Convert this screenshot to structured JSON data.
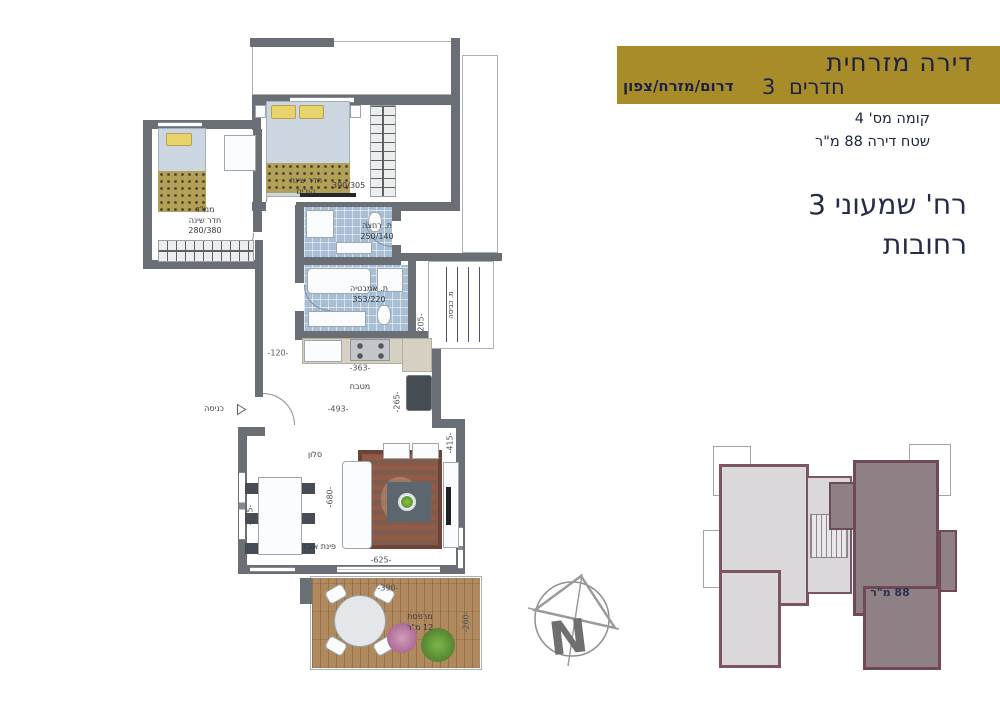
{
  "header": {
    "line1": "דירה  מזרחית",
    "rooms_count": "3",
    "rooms_word": "חדרים",
    "orientation": "דרום/מזרח/צפון",
    "floor": "קומה מס'  4",
    "area": "שטח דירה  88  מ\"ר"
  },
  "address": {
    "line1": "רח' שמעוני 3",
    "line2": "רחובות"
  },
  "plan": {
    "rooms": {
      "mamad": {
        "line1": "ממ\"ד",
        "line2": "חדר שינה",
        "dims": "280/380"
      },
      "parents": {
        "line1": "חדר שינה",
        "line2": "הורים",
        "dims": "390/305"
      },
      "shower": {
        "name": "ת. רחצה",
        "dims": "250/140"
      },
      "bath": {
        "name": "ת. אמבטיה",
        "dims": "353/220"
      },
      "laundry": {
        "name": "מ. כביסה"
      },
      "kitchen": {
        "name": "מטבח"
      },
      "salon": {
        "name": "סלון"
      },
      "dining": {
        "name": "פינת אוכל"
      },
      "balcony": {
        "line1": "מרפסת",
        "line2": "12 מ\"ר"
      },
      "entrance": {
        "name": "כניסה"
      }
    },
    "dims": {
      "hall": "-120-",
      "kitchen_top": "-363-",
      "kitchen_main": "-493-",
      "kitchen_side": "-265-",
      "salon_right": "-415-",
      "salon_mid": "-680-",
      "dining_side": "-305-",
      "salon_bottom": "-625-",
      "balcony_width": "-390-",
      "balcony_depth": "-260-",
      "service": "-205-"
    }
  },
  "keyplan": {
    "area": "88 מ\"ר"
  },
  "compass": {
    "north": "N"
  },
  "colors": {
    "gold": "#a98c2a",
    "navy_text": "#1c2340",
    "plan_wall": "#6a6f76",
    "tile": "#a7bed5",
    "wood": "#b08a5e",
    "keyplan_highlight": "#8e8085",
    "keyplan_wall": "#7b5560"
  }
}
